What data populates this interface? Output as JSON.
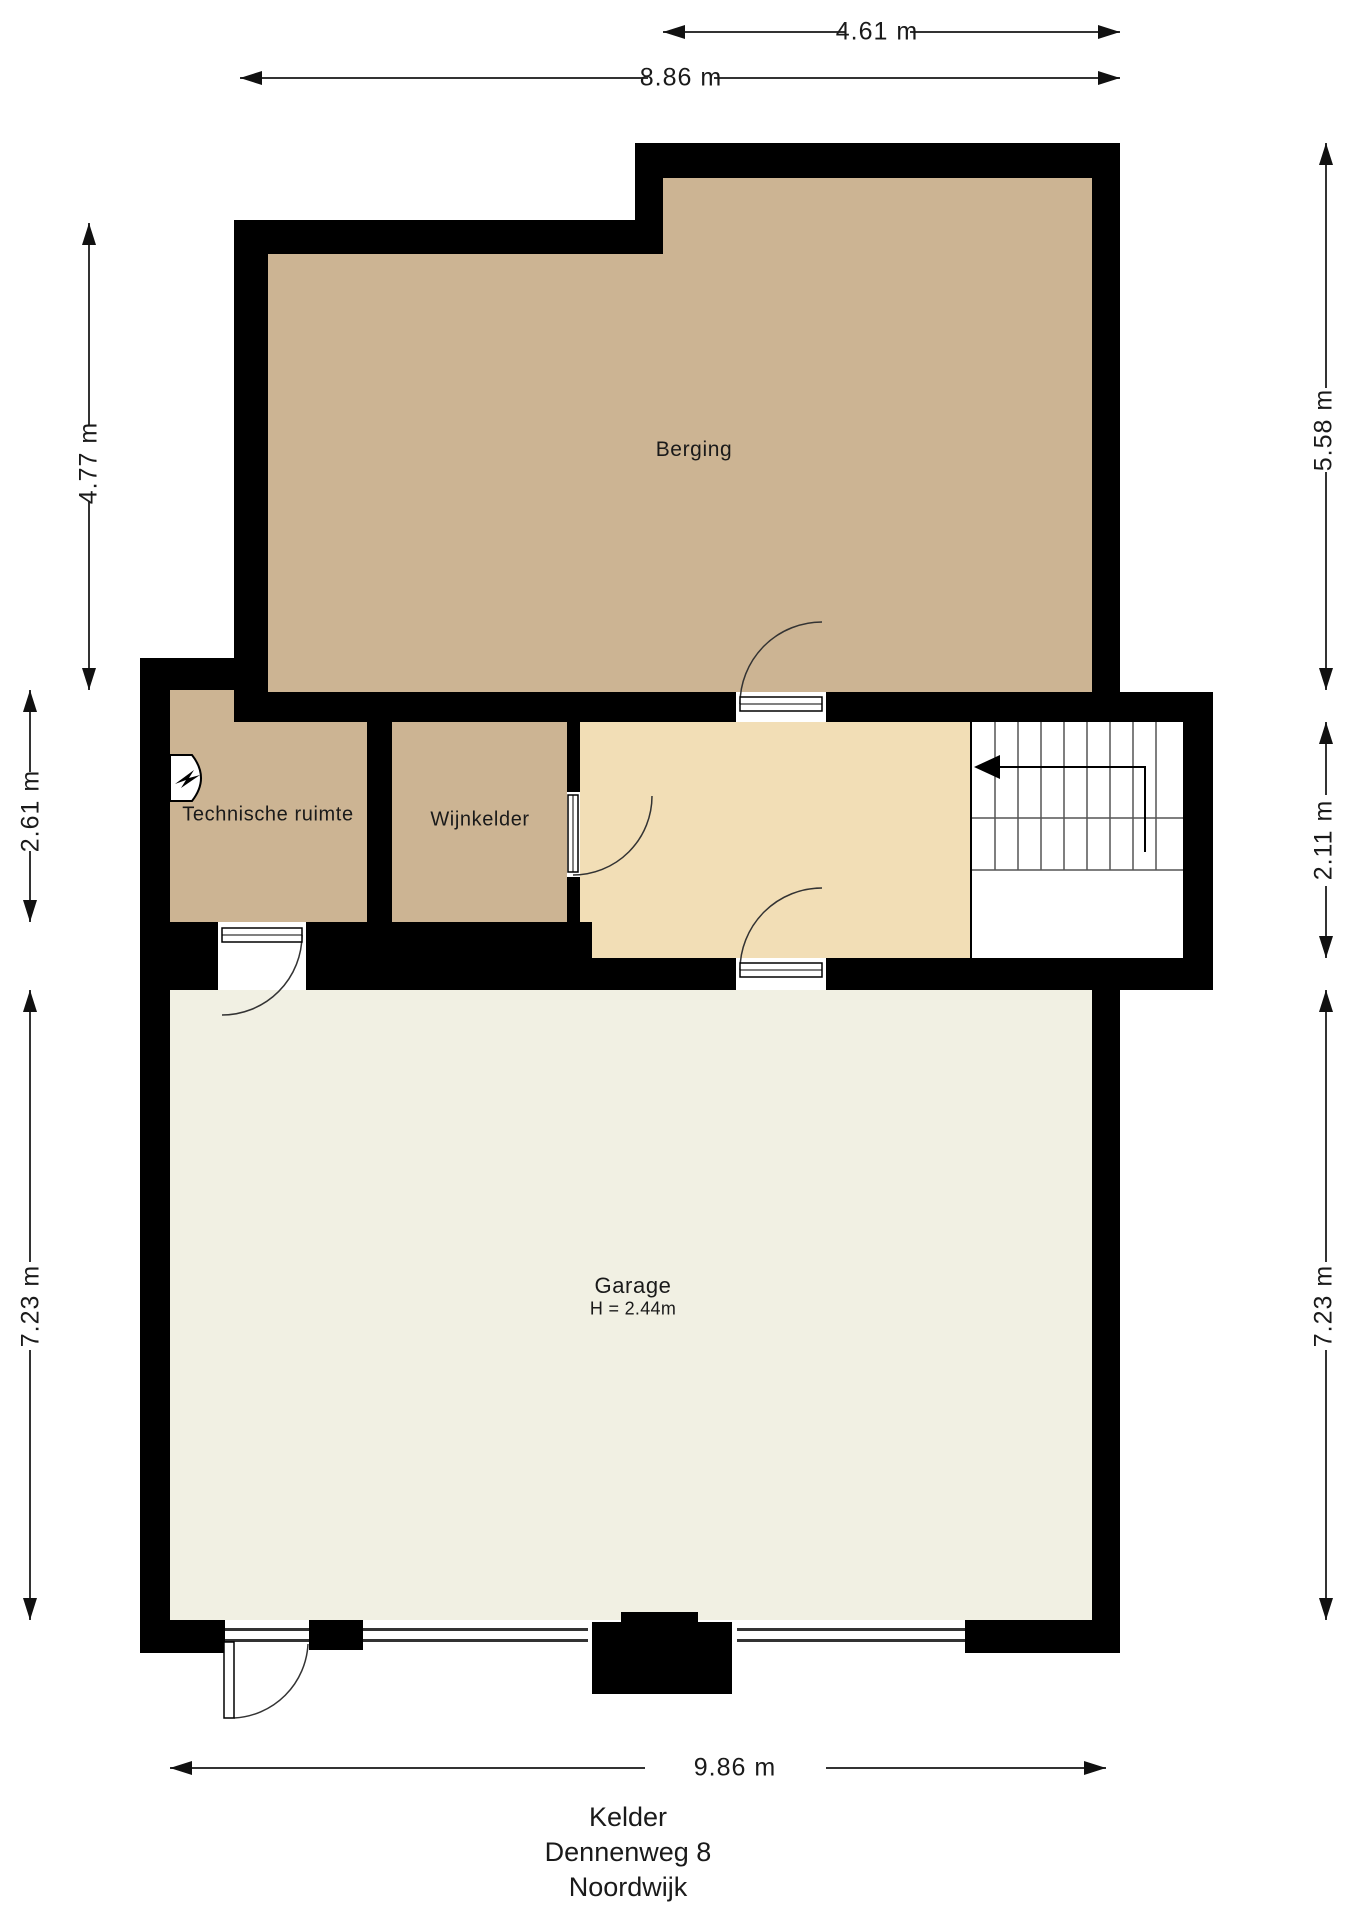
{
  "floorplan": {
    "level_title_lines": [
      "Kelder",
      "Dennenweg 8",
      "Noordwijk"
    ],
    "rooms": {
      "berging": {
        "label": "Berging"
      },
      "technische_ruimte": {
        "label": "Technische ruimte"
      },
      "wijnkelder": {
        "label": "Wijnkelder"
      },
      "garage": {
        "label": "Garage",
        "height_note": "H = 2.44m"
      }
    },
    "dimensions": {
      "top_right_width": "4.61 m",
      "top_full_width": "8.86 m",
      "left_berging_height": "4.77 m",
      "left_middle_height": "2.61 m",
      "left_garage_height": "7.23 m",
      "right_berging_height": "5.58 m",
      "right_stairs_height": "2.11 m",
      "right_garage_height": "7.23 m",
      "bottom_garage_width": "9.86 m"
    },
    "icons": {
      "boiler": "boiler-icon",
      "stairs_arrow": "stairs-direction-arrow"
    },
    "colors": {
      "page_bg": "#ffffff",
      "wall": "#000000",
      "room_tan": "#ccb493",
      "room_cream": "#f2deb6",
      "room_ivory": "#f1f0e3",
      "stairs_bg": "#ffffff",
      "line": "#333333",
      "thin_line": "#555555",
      "text": "#1a1a1a"
    }
  }
}
